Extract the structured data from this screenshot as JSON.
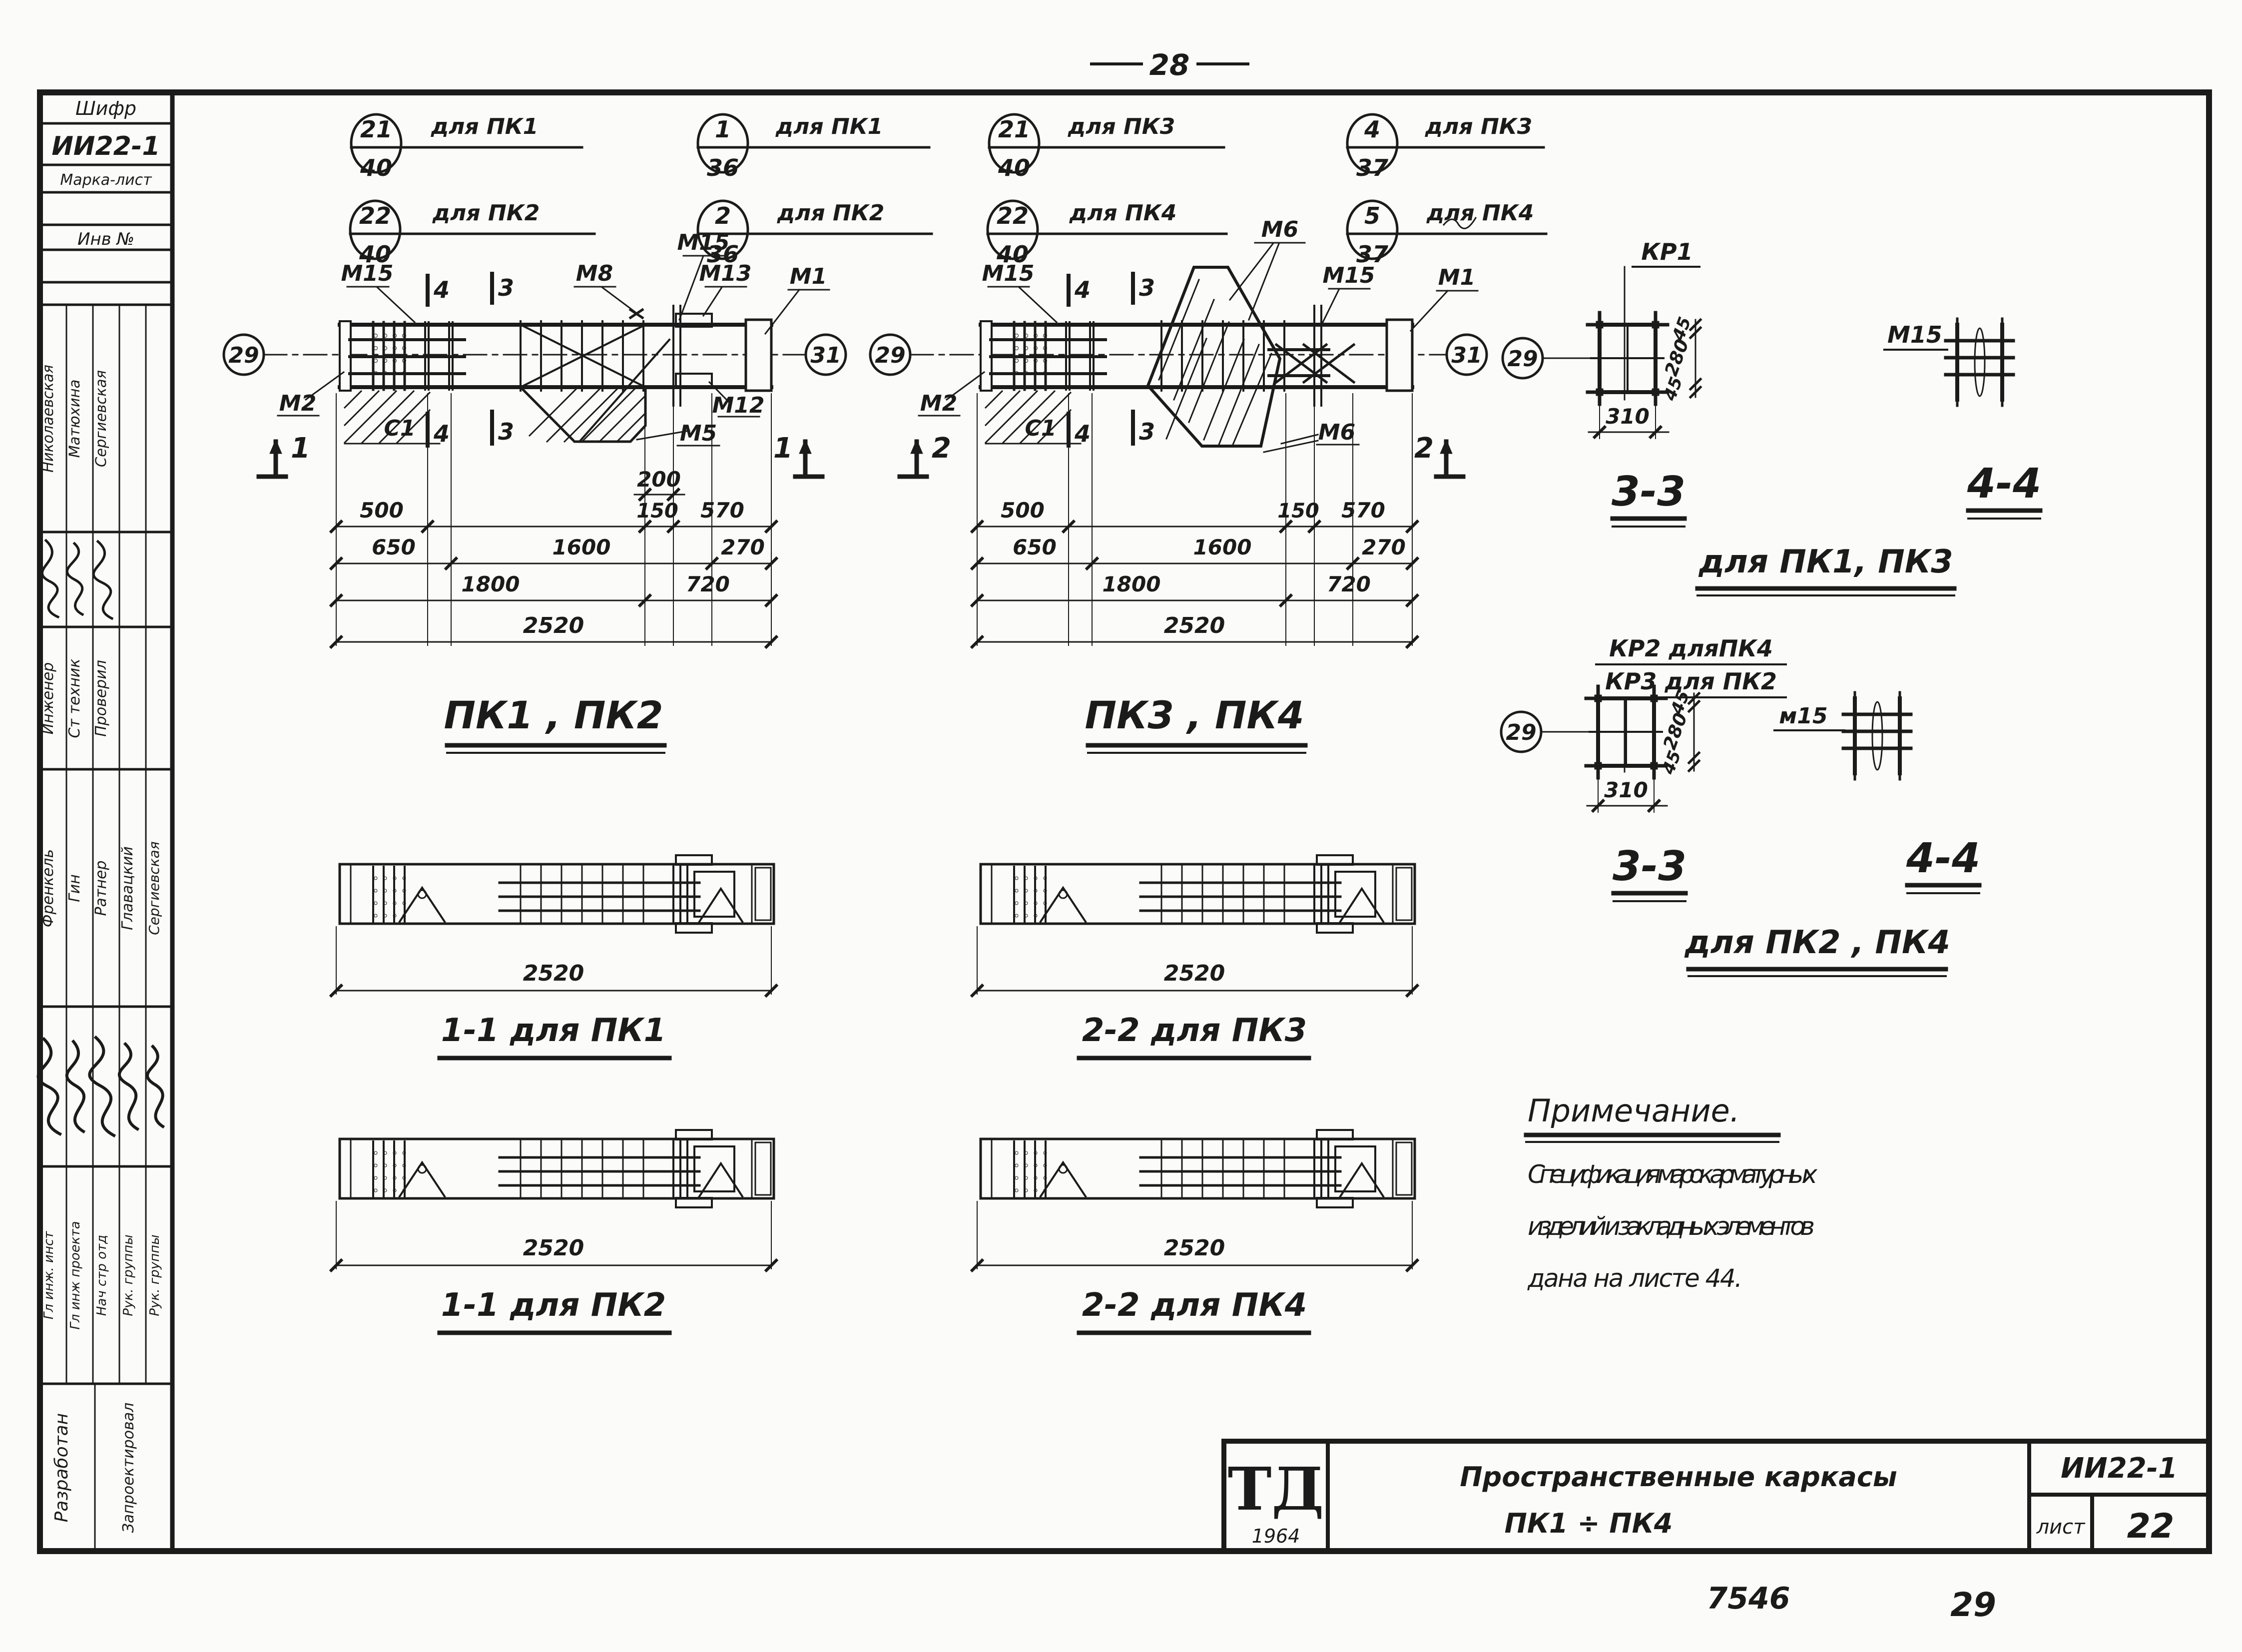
{
  "page": {
    "top_number": "28",
    "bottom_code": "7546",
    "bottom_number": "29"
  },
  "sidebar": {
    "code_label": "Шифр",
    "code_value": "ИИ22-1",
    "marka_label": "Марка-лист",
    "inv_label": "Инв №",
    "names_top": [
      "Николаевская",
      "Матюхина",
      "Сергиевская"
    ],
    "roles_top": [
      "Инженер",
      "Ст техник",
      "Проверил"
    ],
    "names_mid": [
      "Френкель",
      "Гин",
      "Ратнер",
      "Главацкий",
      "Сергиевская"
    ],
    "roles_bottom": [
      "Гл инж. инст",
      "Гл инж проекта",
      "Нач стр отд",
      "Рук. группы",
      "Рук. группы"
    ],
    "developed_label": "Разработан",
    "designed_label": "Запроектировал"
  },
  "callouts": [
    {
      "top": "21",
      "bottom": "40",
      "note": "для ПК1"
    },
    {
      "top": "22",
      "bottom": "40",
      "note": "для ПК2"
    },
    {
      "top": "1",
      "bottom": "36",
      "note": "для ПК1"
    },
    {
      "top": "2",
      "bottom": "36",
      "note": "для ПК2"
    },
    {
      "top": "21",
      "bottom": "40",
      "note": "для ПК3"
    },
    {
      "top": "22",
      "bottom": "40",
      "note": "для ПК4"
    },
    {
      "top": "4",
      "bottom": "37",
      "note": "для ПК3"
    },
    {
      "top": "5",
      "bottom": "37",
      "note": "для ПК4"
    }
  ],
  "beam1": {
    "title": "ПК1 ,  ПК2",
    "axis_left": "29",
    "axis_right": "31",
    "cut_mark": "1",
    "mark4": "4",
    "mark3": "3",
    "m15_left": "М15",
    "m15_mid": "М15",
    "m8": "М8",
    "m13": "М13",
    "m1": "М1",
    "m2": "М2",
    "c1": "С1",
    "m5": "М5",
    "m12": "М12",
    "d200": "200",
    "d500": "500",
    "d150": "150",
    "d570": "570",
    "d650": "650",
    "d1600": "1600",
    "d270": "270",
    "d1800": "1800",
    "d720": "720",
    "d2520": "2520"
  },
  "beam2": {
    "title": "ПК3 ,  ПК4",
    "axis_left": "29",
    "axis_right": "31",
    "cut_mark": "2",
    "mark4": "4",
    "mark3": "3",
    "m15_left": "М15",
    "m6_top": "М6",
    "m15_right": "М15",
    "m1": "М1",
    "m2": "М2",
    "c1": "С1",
    "m6_bottom": "М6",
    "d500": "500",
    "d150": "150",
    "d570": "570",
    "d650": "650",
    "d1600": "1600",
    "d270": "270",
    "d1800": "1800",
    "d720": "720",
    "d2520": "2520"
  },
  "plans": [
    {
      "dim": "2520",
      "caption": "1-1 для ПК1"
    },
    {
      "dim": "2520",
      "caption": "2-2 для ПК3"
    },
    {
      "dim": "2520",
      "caption": "1-1 для ПК2"
    },
    {
      "dim": "2520",
      "caption": "2-2 для ПК4"
    }
  ],
  "sections": [
    {
      "kr_label": "КР1",
      "kr_label2": "",
      "axis": "29",
      "m15": "М15",
      "dim_w": "310",
      "side_top": "45",
      "side_mid": "280",
      "side_bot": "45",
      "title_a": "3-3",
      "title_b": "4-4",
      "subtitle": "для ПК1,  ПК3"
    },
    {
      "kr_label": "КР2 дляПК4",
      "kr_label2": "КР3 для ПК2",
      "axis": "29",
      "m15": "м15",
      "dim_w": "310",
      "side_top": "45",
      "side_mid": "280",
      "side_bot": "45",
      "title_a": "3-3",
      "title_b": "4-4",
      "subtitle": "для ПК2 ,  ПК4"
    }
  ],
  "note": {
    "title": "Примечание.",
    "line1": "Спецификация    марок    арматурных",
    "line2": "изделий   и   закладных   элементов",
    "line3": "дана   на   листе   44."
  },
  "title_block": {
    "logo": "ТД",
    "logo_year": "1964",
    "title_line1": "Пространственные    каркасы",
    "title_line2": "ПК1 ÷ ПК4",
    "doc_code": "ИИ22-1",
    "sheet_label": "лист",
    "sheet_number": "22"
  }
}
